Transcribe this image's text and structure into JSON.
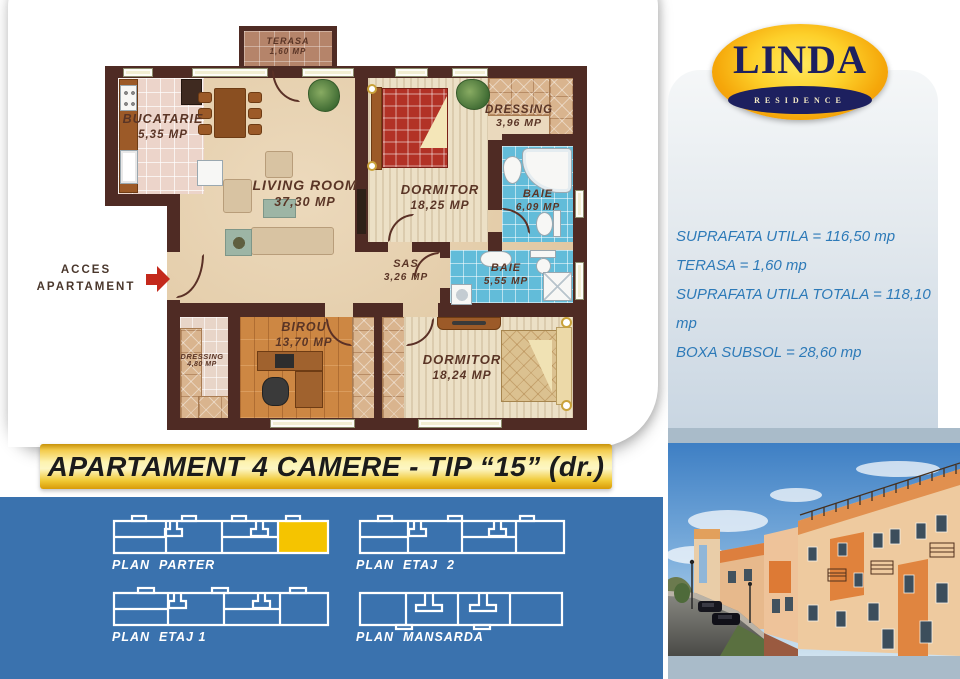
{
  "logo": {
    "name": "LINDA",
    "subtitle": "RESIDENCE"
  },
  "banner": {
    "title": "APARTAMENT 4 CAMERE - TIP “15” (dr.)"
  },
  "stats": {
    "lines": [
      "SUPRAFATA UTILA = 116,50 mp",
      "TERASA = 1,60 mp",
      "SUPRAFATA UTILA TOTALA = 118,10 mp",
      "BOXA SUBSOL = 28,60 mp"
    ]
  },
  "floor_plan": {
    "access": {
      "line1": "ACCES",
      "line2": "APARTAMENT"
    },
    "rooms": {
      "terasa": {
        "name": "TERASA",
        "area": "1,60 MP"
      },
      "bucatarie": {
        "name": "BUCATARIE",
        "area": "5,35 MP"
      },
      "living": {
        "name": "LIVING ROOM",
        "area": "37,30 MP"
      },
      "dressing1": {
        "name": "DRESSING",
        "area": "3,96 MP"
      },
      "dormitor1": {
        "name": "DORMITOR",
        "area": "18,25 MP"
      },
      "baie1": {
        "name": "BAIE",
        "area": "6,09 MP"
      },
      "sas": {
        "name": "SAS",
        "area": "3,26 MP"
      },
      "baie2": {
        "name": "BAIE",
        "area": "5,55 MP"
      },
      "birou": {
        "name": "BIROU",
        "area": "13,70 MP"
      },
      "dressing2": {
        "name": "DRESSING",
        "area": "4,80 MP"
      },
      "dormitor2": {
        "name": "DORMITOR",
        "area": "18,24 MP"
      }
    }
  },
  "plans": [
    {
      "label": "PLAN  PARTER",
      "highlighted": true
    },
    {
      "label": "PLAN  ETAJ  2",
      "highlighted": false
    },
    {
      "label": "PLAN  ETAJ 1",
      "highlighted": false
    },
    {
      "label": "PLAN  MANSARDA",
      "highlighted": false
    }
  ],
  "colors": {
    "blue_section": "#3a72ae",
    "banner_gold": "#f0c832",
    "logo_navy": "#1d205f",
    "logo_orange": "#f5a70a",
    "stats_text": "#2d7ab8",
    "plan_highlight": "#f5c400",
    "wall_brown": "#4f2b24"
  }
}
